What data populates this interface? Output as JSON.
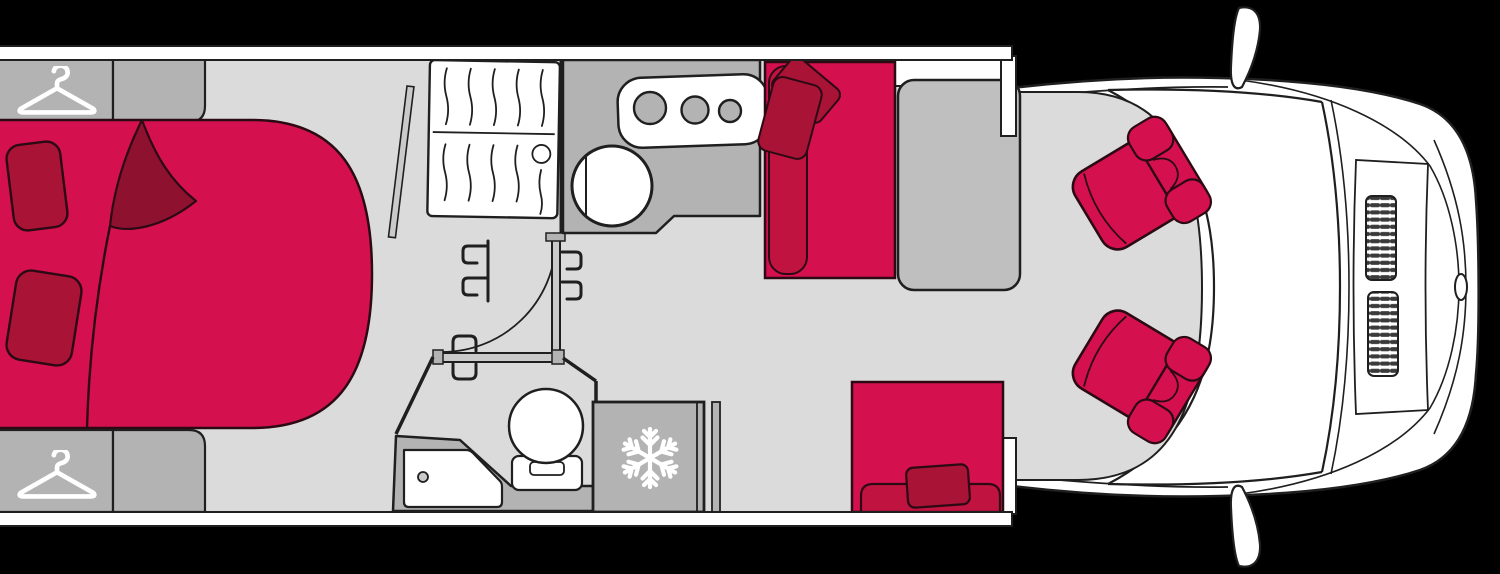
{
  "palette": {
    "bg": "#000000",
    "wall": "#ffffff",
    "floor": "#dbdbdb",
    "furniture": "#b3b3b3",
    "furniture-light": "#cacaca",
    "table": "#bfbfbf",
    "red": "#d5104e",
    "red-mid": "#c01340",
    "red-deep": "#a81336",
    "red-dark": "#8e1130",
    "outline": "#1f1f1f",
    "outline-red": "#2b0a14",
    "vent": "#3a3a3a"
  },
  "icons": {
    "hanger": "clothes-hanger",
    "snowflake": "snowflake"
  },
  "components": {
    "floorplan": "motorhome floor plan, top view",
    "bed": "double bed with red bedspread",
    "bed_blanket": "folded-back blanket corner",
    "bed_pillow_1": "bed pillow",
    "bed_pillow_2": "bed pillow",
    "wardrobe_top": "wardrobe with clothes hanger",
    "wardrobe_bottom": "wardrobe with clothes hanger",
    "cabinet_top": "bedside cabinet",
    "cabinet_bottom": "bedside cabinet",
    "slatted_unit": "slatted cabinet front",
    "kitchen_counter": "kitchen worktop",
    "hob": "three-burner gas hob",
    "sink": "round kitchen sink",
    "bathroom": "washroom",
    "shower": "shower tray with drain",
    "toilet": "toilet",
    "fridge": "refrigerator",
    "interior_door": "interior partition door with swing arc",
    "dinette_bench": "dinette bench seat with cushions",
    "dinette_table": "dinette table",
    "rear_bench": "travel bench seat with cushion",
    "cab": "vehicle cab front with windscreen and bonnet",
    "cab_floor": "cab floor",
    "driver_seat": "swivelled cab seat",
    "passenger_seat": "swivelled cab seat",
    "mirror_top": "wing mirror",
    "mirror_bottom": "wing mirror",
    "grille_vent": "bonnet air vent",
    "badge": "front badge"
  }
}
